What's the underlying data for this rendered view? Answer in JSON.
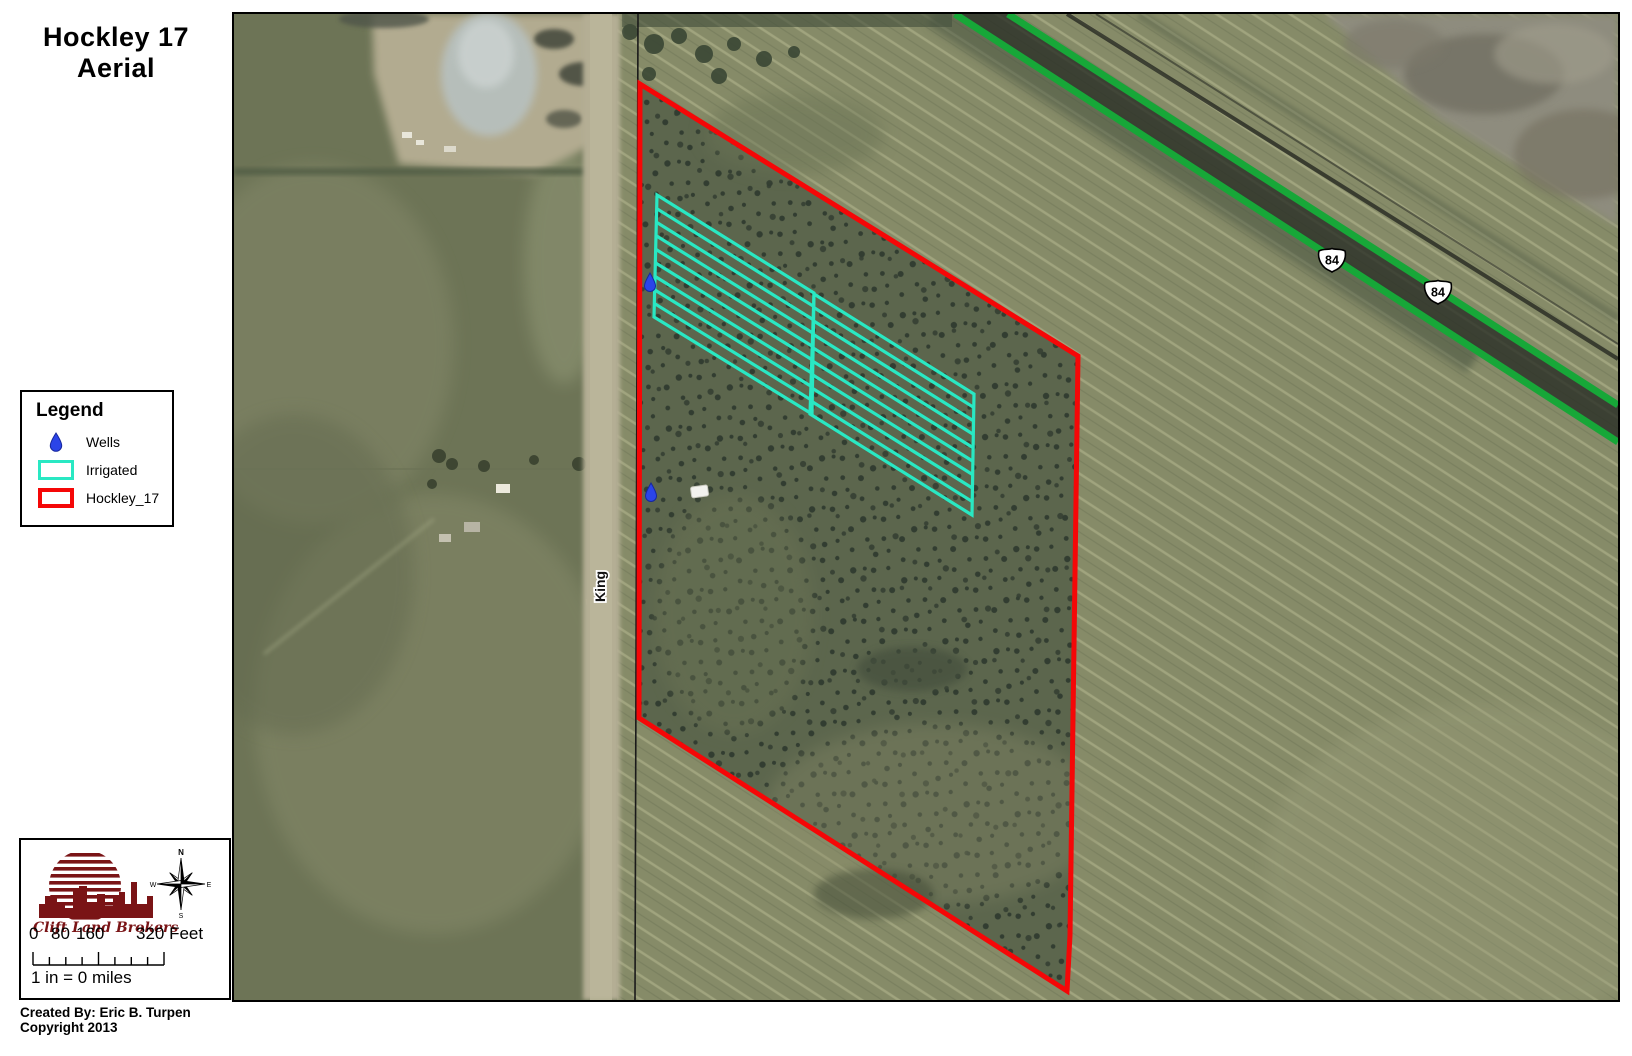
{
  "title": {
    "line1": "Hockley 17",
    "line2": "Aerial"
  },
  "legend": {
    "title": "Legend",
    "items": [
      {
        "label": "Wells"
      },
      {
        "label": "Irrigated"
      },
      {
        "label": "Hockley_17"
      }
    ]
  },
  "map": {
    "road_label": "King",
    "shields": [
      {
        "label": "84"
      },
      {
        "label": "84"
      }
    ]
  },
  "colors": {
    "hockley_boundary": "#f50707",
    "irrigated": "#29e8c3",
    "wells": "#2b44e8",
    "highway": "#17a738",
    "logo_maroon": "#7a1416"
  },
  "scale": {
    "tick0": "0",
    "tick1": "80",
    "tick2": "160",
    "tick3": "320 Feet",
    "equivalence": "1 in = 0 miles"
  },
  "compass": {
    "n": "N",
    "e": "E",
    "s": "S",
    "w": "W"
  },
  "logo": {
    "name": "Clift Land Brokers"
  },
  "credits": {
    "line1": "Created By: Eric B. Turpen",
    "line2": "Copyright 2013"
  }
}
